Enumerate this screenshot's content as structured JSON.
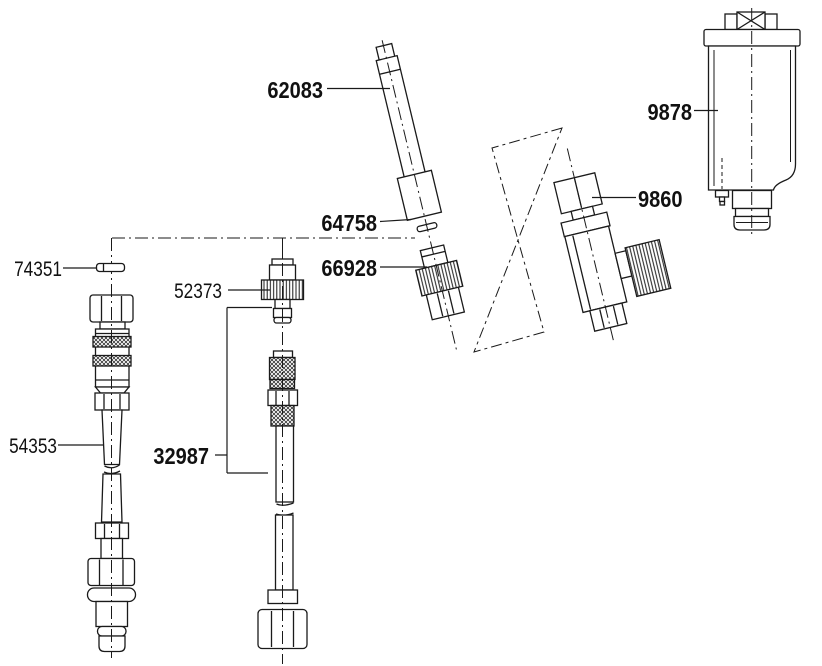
{
  "colors": {
    "background": "#ffffff",
    "line": "#1a1a1a",
    "text": "#111111"
  },
  "labels": {
    "p62083": "62083",
    "p64758": "64758",
    "p66928": "66928",
    "p74351": "74351",
    "p52373": "52373",
    "p54353": "54353",
    "p32987": "32987",
    "p9878": "9878",
    "p9860": "9860"
  }
}
